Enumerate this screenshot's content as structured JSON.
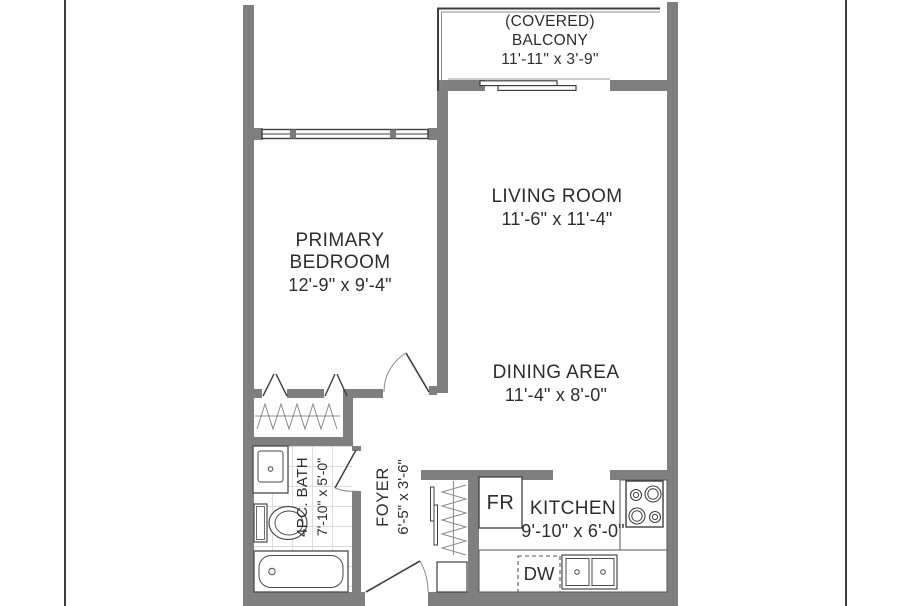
{
  "title": "Apartment floor plan",
  "colors": {
    "wall": "#7f7f7f",
    "line": "#3f3f3f",
    "arc": "#8a8a8a",
    "tile": "#dcdcdc",
    "text": "#2d2d2d",
    "background": "#ffffff"
  },
  "rooms": {
    "balcony": {
      "line1": "(COVERED)",
      "line2": "BALCONY",
      "dims": "11'-11\" x 3'-9\""
    },
    "living_room": {
      "name": "LIVING ROOM",
      "dims": "11'-6\" x 11'-4\""
    },
    "primary_bedroom": {
      "line1": "PRIMARY",
      "line2": "BEDROOM",
      "dims": "12'-9\" x 9'-4\""
    },
    "dining_area": {
      "name": "DINING AREA",
      "dims": "11'-4\" x 8'-0\""
    },
    "bath": {
      "name": "4PC. BATH",
      "dims": "7'-10\" x 5'-0\""
    },
    "foyer": {
      "name": "FOYER",
      "dims": "6'-5\" x 3'-6\""
    },
    "kitchen": {
      "name": "KITCHEN",
      "dims": "9'-10\" x 6'-0\""
    }
  },
  "appliances": {
    "fridge": "FR",
    "dishwasher": "DW"
  }
}
